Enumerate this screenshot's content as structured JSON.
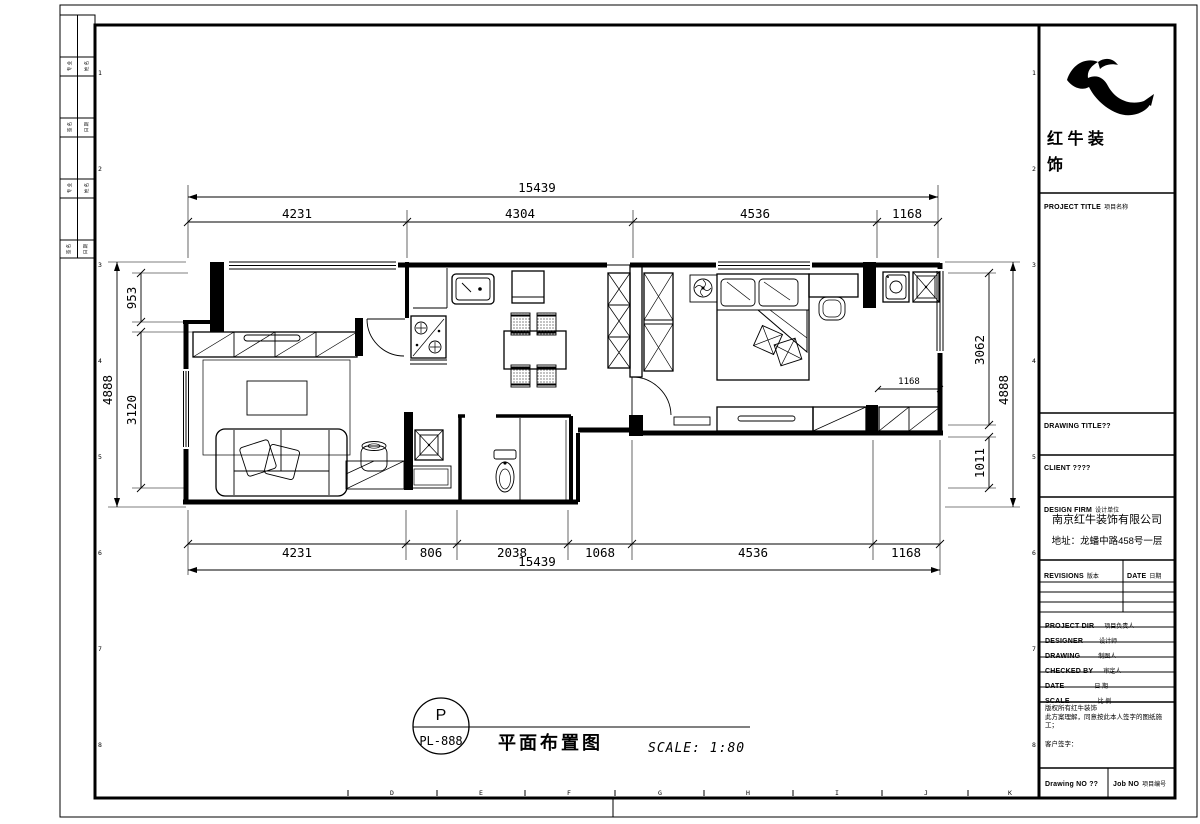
{
  "drawing": {
    "dims": {
      "top_overall": "15439",
      "top_segments": [
        "4231",
        "4304",
        "4536",
        "1168"
      ],
      "bottom_overall": "15439",
      "bottom_segments": [
        "4231",
        "806",
        "2038",
        "1068",
        "4536",
        "1168"
      ],
      "left_overall": "4888",
      "left_segments": [
        "953",
        "3120"
      ],
      "right_overall": "4888",
      "right_segments": [
        "3062",
        "1011"
      ],
      "interior_dim": "1168"
    },
    "stamp": {
      "tag_top": "P",
      "tag_bottom": "PL-888",
      "title": "平面布置图",
      "scale": "SCALE: 1:80"
    },
    "grid": {
      "bottom_letters": [
        "D",
        "E",
        "F",
        "G",
        "H",
        "I",
        "J",
        "K"
      ],
      "row_numbers": [
        "1",
        "2",
        "3",
        "4",
        "5",
        "6",
        "7",
        "8"
      ]
    }
  },
  "signoff": {
    "cells": [
      "专 业",
      "姓 名",
      "签 名",
      "日 期",
      "专 业",
      "姓 名",
      "签 名",
      "日 期"
    ]
  },
  "title_block": {
    "brand": {
      "line1": "红 牛 装",
      "line2": "饰"
    },
    "sections": {
      "project_title": "PROJECT TITLE",
      "project_title_cn": "项目名称",
      "drawing_title": "DRAWING TITLE??",
      "client": "CLIENT ????",
      "design_firm": "DESIGN FIRM",
      "design_firm_cn": "设计单位",
      "company": "南京红牛装饰有限公司",
      "address": "地址：龙蟠中路458号一层"
    },
    "table": {
      "revisions": "REVISIONS",
      "revisions_cn": "版本",
      "date_col": "DATE",
      "date_col_cn": "日期",
      "rows": [
        {
          "en": "PROJECT DIR",
          "cn": "项目负责人"
        },
        {
          "en": "DESIGNER",
          "cn": "设计师"
        },
        {
          "en": "DRAWING",
          "cn": "制图人"
        },
        {
          "en": "CHECKED BY",
          "cn": "审定人"
        },
        {
          "en": "DATE",
          "cn": "日 期"
        },
        {
          "en": "SCALE",
          "cn": "比 例"
        }
      ]
    },
    "notes": {
      "line1": "版权所有红牛装饰",
      "line2": "此方案理解，同意按此本人签字的图纸施工；",
      "line3": "客户签字："
    },
    "footer": {
      "drawing_no": "Drawing NO ??",
      "job_no": "Job NO",
      "job_no_cn": "项目编号"
    }
  }
}
